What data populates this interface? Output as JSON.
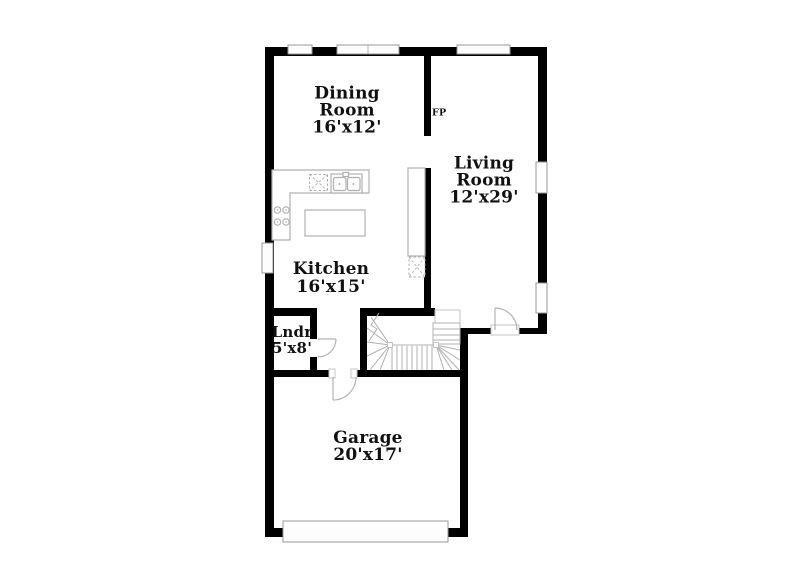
{
  "title": "First floor plan",
  "colors": {
    "wall": "#000000",
    "fixture": "#b0b0b0",
    "window_fill": "#fdfdfd",
    "ink": "#111111",
    "paper": "#ffffff"
  },
  "rooms": {
    "dining": {
      "name": "Dining Room",
      "dims": "16'x12'"
    },
    "living": {
      "name": "Living Room",
      "dims": "12'x29'"
    },
    "kitchen": {
      "name": "Kitchen",
      "dims": "16'x15'"
    },
    "laundry": {
      "name": "Lndr",
      "dims": "5'x8'"
    },
    "garage": {
      "name": "Garage",
      "dims": "20'x17'"
    }
  },
  "annotations": {
    "fireplace": "FP"
  },
  "fixture_icons": {
    "sink": "double-basin-sink",
    "range": "four-burner-cooktop",
    "dishwasher": "dashed-x-appliance",
    "pantry": "dashed-x-appliance",
    "island": "kitchen-island-counter",
    "refrigerator": "tall-counter",
    "stairs": "winder-staircase",
    "doors": "quarter-swing-door",
    "windows": "wall-window",
    "garage_door": "garage-door-panel"
  }
}
